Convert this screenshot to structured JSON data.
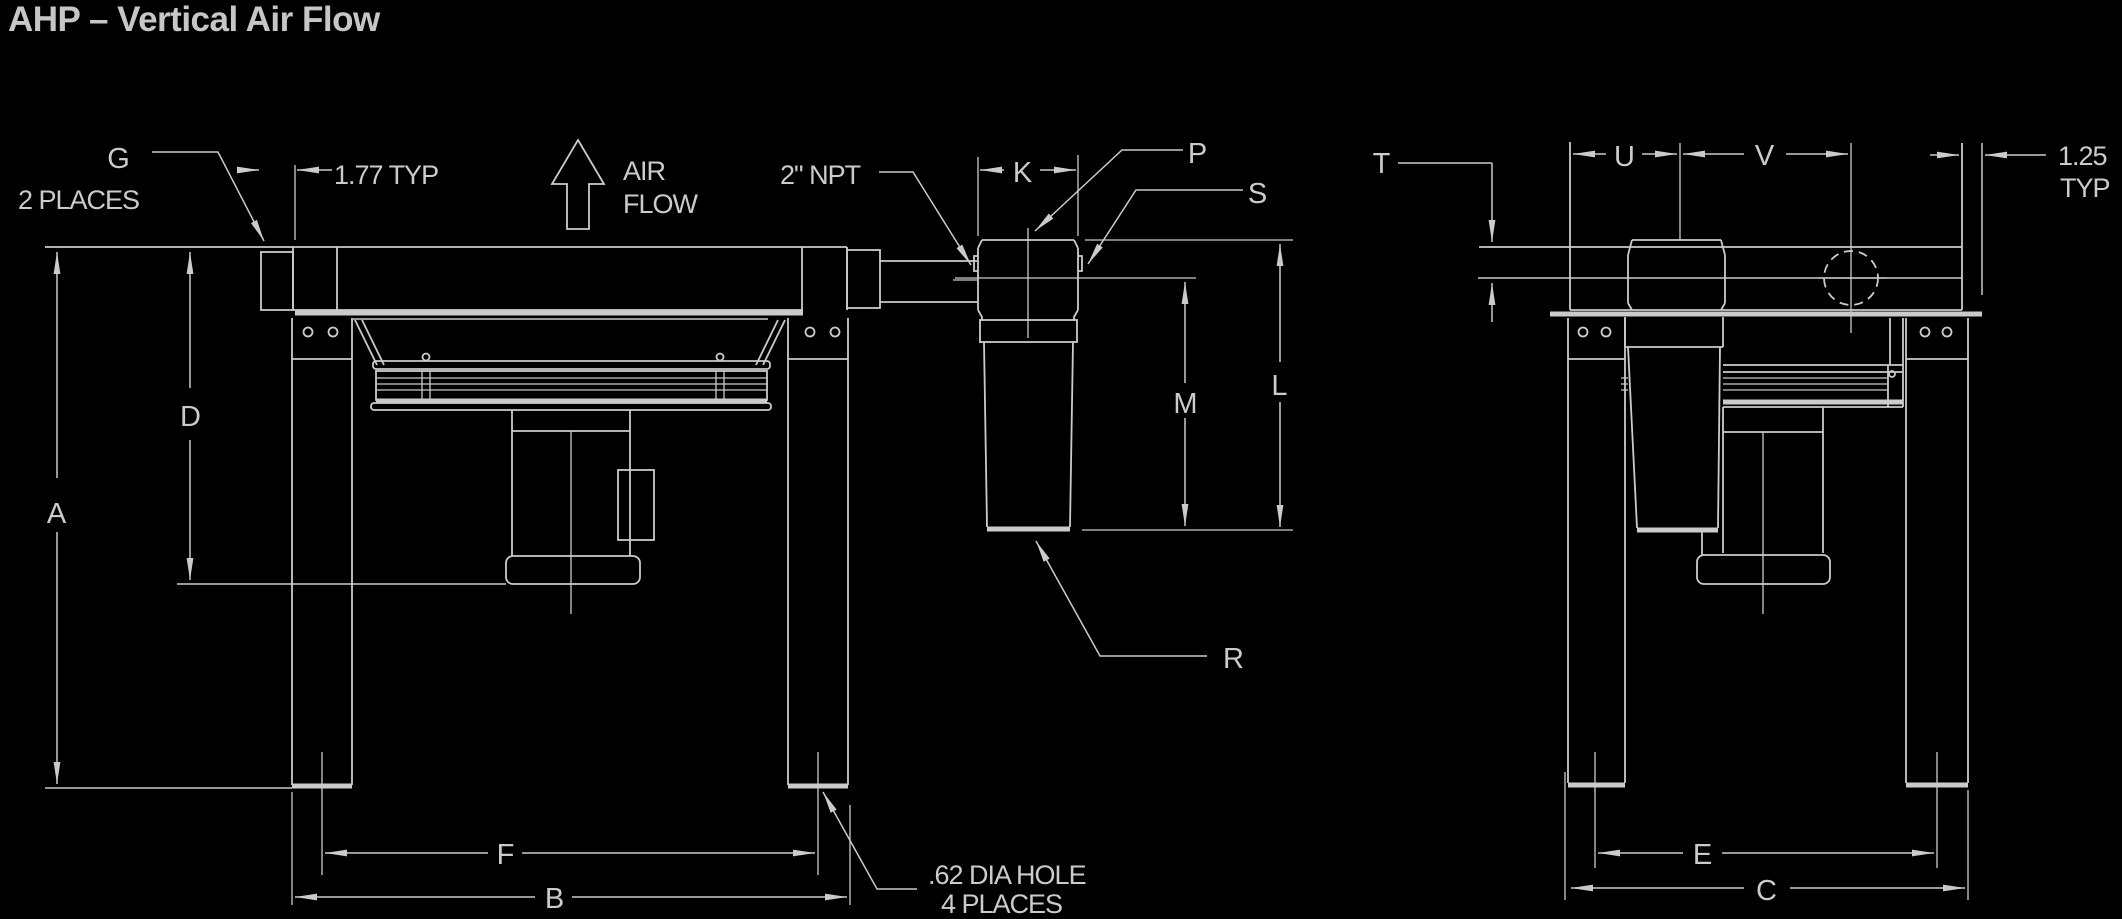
{
  "title": "AHP – Vertical Air Flow",
  "colors": {
    "background": "#000000",
    "linework": "#cbcbcb",
    "title_text": "#c6c6c6"
  },
  "front_view": {
    "name": "front elevation with vertical air flow",
    "dim_labels": {
      "a": "A",
      "b": "B",
      "d": "D",
      "f": "F",
      "g": "G",
      "k": "K",
      "l": "L",
      "m": "M",
      "p": "P",
      "r": "R",
      "s": "S"
    },
    "annotations": {
      "g_places": "2 PLACES",
      "typ_177": "1.77 TYP",
      "air_line1": "AIR",
      "air_line2": "FLOW",
      "npt": "2\" NPT",
      "hole_line1": ".62 DIA HOLE",
      "hole_line2": "4 PLACES"
    }
  },
  "end_view": {
    "name": "end elevation",
    "dim_labels": {
      "t": "T",
      "u": "U",
      "v": "V",
      "e": "E",
      "c": "C"
    },
    "annotations": {
      "typ_125_line1": "1.25",
      "typ_125_line2": "TYP"
    }
  }
}
